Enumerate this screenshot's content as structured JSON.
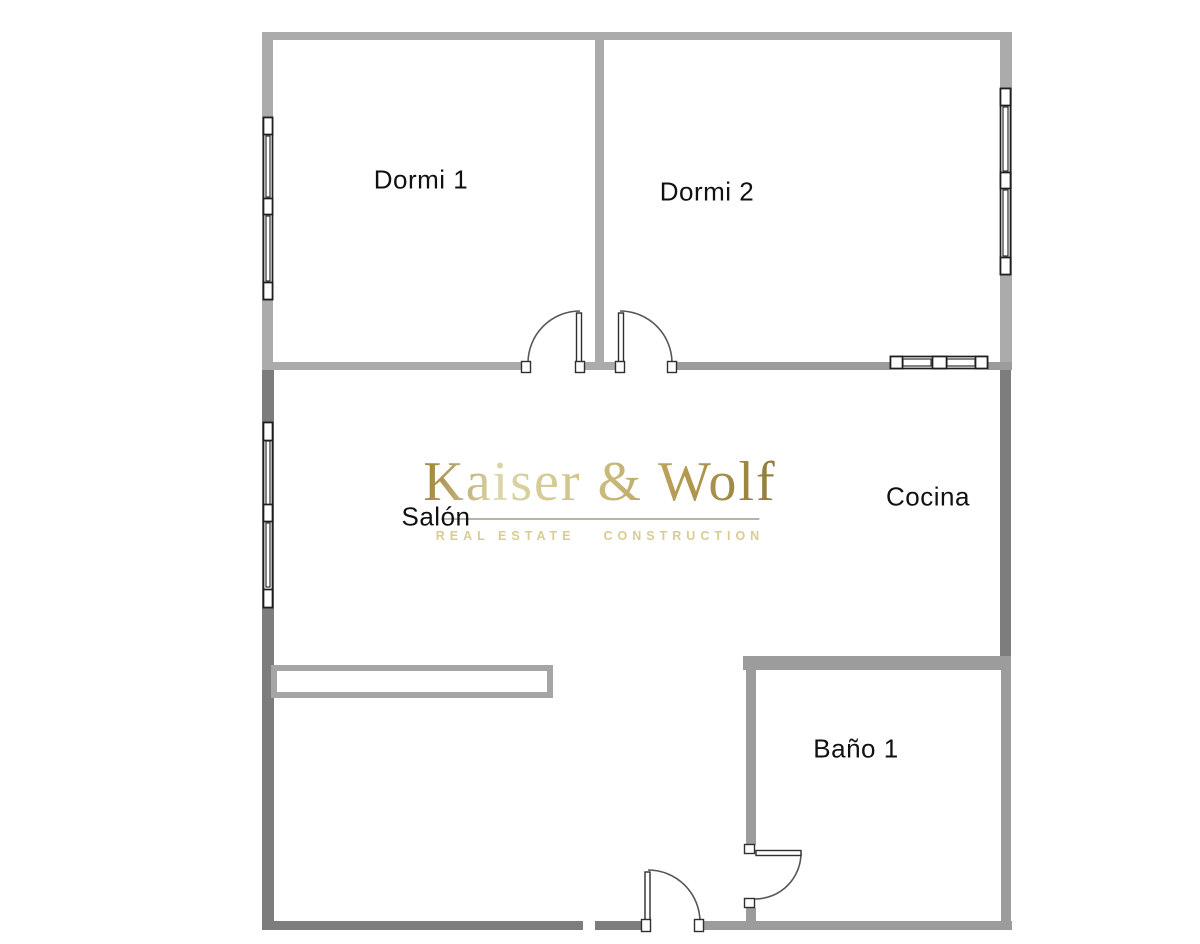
{
  "plan": {
    "rooms": [
      {
        "id": "dormi-1",
        "label": "Dormi 1"
      },
      {
        "id": "dormi-2",
        "label": "Dormi 2"
      },
      {
        "id": "salon",
        "label": "Salón"
      },
      {
        "id": "cocina",
        "label": "Cocina"
      },
      {
        "id": "bano-1",
        "label": "Baño 1"
      }
    ],
    "features": {
      "windows": [
        "dormi-1-left-window",
        "dormi-2-right-window",
        "cocina-top-window",
        "salon-left-window"
      ],
      "doors": [
        "dormi-1-door",
        "dormi-2-door",
        "entrance-door",
        "bano-door"
      ]
    }
  },
  "watermark": {
    "brand": "Kaiser & Wolf",
    "tagline_left": "REAL ESTATE",
    "tagline_right": "CONSTRUCTION"
  },
  "colors": {
    "wall-light": "#ababab",
    "wall-mid": "#9c9c9c",
    "wall-dark": "#7d7d7d",
    "frame-ink": "#1f1f1f",
    "gold": "#b2964a",
    "gold-pale": "#d8ce9b",
    "tagline-gold": "#d8cc92",
    "label-ink": "#111111"
  }
}
